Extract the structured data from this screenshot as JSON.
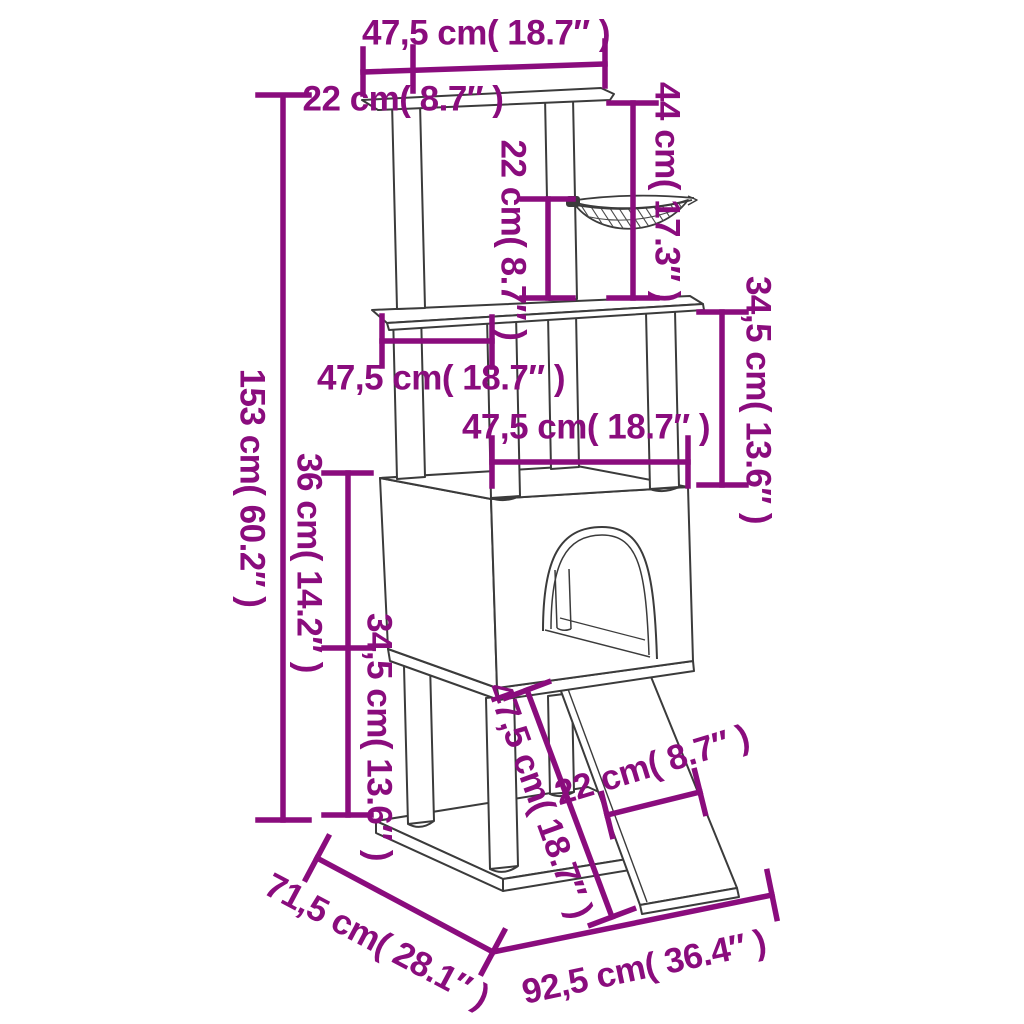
{
  "diagram": {
    "type": "product-dimension-diagram",
    "subject": "cat tree with scratching posts, hammock, condo and ramp",
    "accent_color": "#8a0c7d",
    "line_color": "#3b3b3b",
    "background": "#ffffff"
  },
  "dimensions": {
    "top_platform_width": {
      "text": "47,5 cm( 18.7″  )",
      "metric": "47,5 cm",
      "imperial": "18.7″"
    },
    "top_platform_depth": {
      "text": "22 cm( 8.7″  )",
      "metric": "22 cm",
      "imperial": "8.7″"
    },
    "hammock_drop": {
      "text": "44 cm( 17.3″  )",
      "metric": "44 cm",
      "imperial": "17.3″"
    },
    "hammock_height": {
      "text": "22 cm( 8.7″  )",
      "metric": "22 cm",
      "imperial": "8.7″"
    },
    "upper_section_height": {
      "text": "34,5 cm( 13.6″  )",
      "metric": "34,5 cm",
      "imperial": "13.6″"
    },
    "total_height": {
      "text": "153 cm( 60.2″  )",
      "metric": "153 cm",
      "imperial": "60.2″"
    },
    "middle_platform_width": {
      "text": "47,5 cm( 18.7″  )",
      "metric": "47,5 cm",
      "imperial": "18.7″"
    },
    "condo_width": {
      "text": "47,5 cm( 18.7″  )",
      "metric": "47,5 cm",
      "imperial": "18.7″"
    },
    "condo_height": {
      "text": "36 cm( 14.2″  )",
      "metric": "36 cm",
      "imperial": "14.2″"
    },
    "lower_section_height": {
      "text": "34,5 cm( 13.6″  )",
      "metric": "34,5 cm",
      "imperial": "13.6″"
    },
    "ramp_length": {
      "text": "47,5 cm( 18.7″  )",
      "metric": "47,5 cm",
      "imperial": "18.7″"
    },
    "ramp_width": {
      "text": "22 cm( 8.7″  )",
      "metric": "22 cm",
      "imperial": "8.7″"
    },
    "base_depth": {
      "text": "71,5 cm( 28.1″  )",
      "metric": "71,5 cm",
      "imperial": "28.1″"
    },
    "base_width": {
      "text": "92,5 cm( 36.4″  )",
      "metric": "92,5 cm",
      "imperial": "36.4″"
    }
  }
}
